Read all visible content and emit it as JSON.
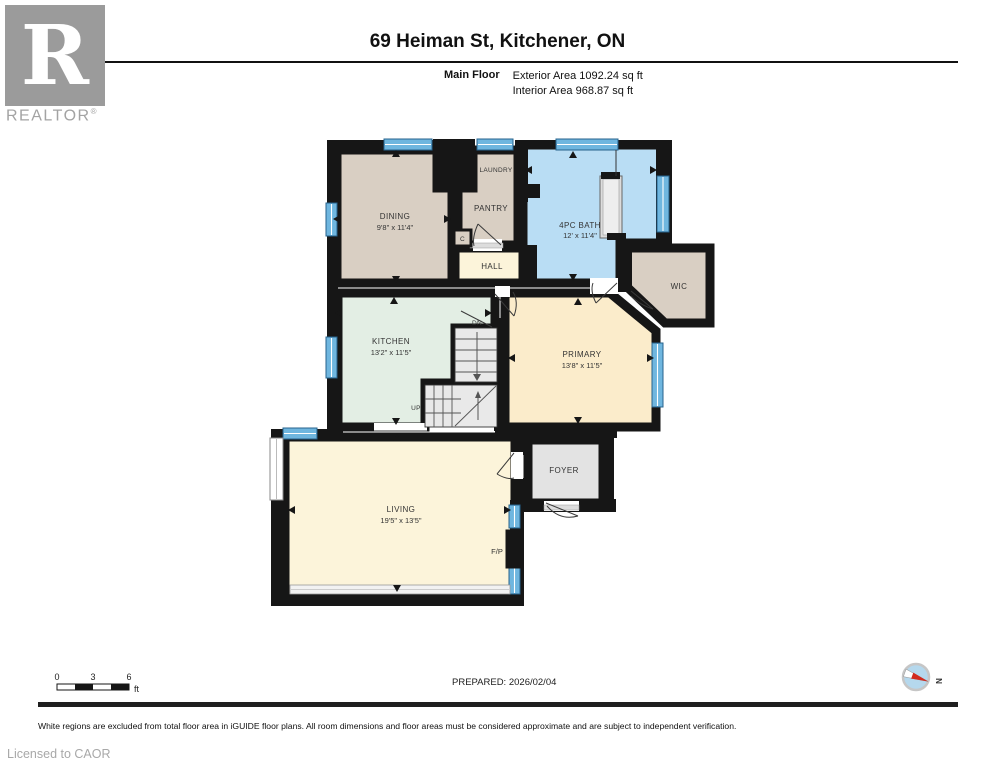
{
  "header": {
    "title": "69 Heiman St, Kitchener, ON",
    "floor_label": "Main Floor",
    "exterior_area": "Exterior Area 1092.24 sq ft",
    "interior_area": "Interior Area 968.87 sq ft",
    "logo_letter": "R",
    "logo_text": "REALTOR",
    "logo_registered": "®"
  },
  "rooms": {
    "dining": {
      "label": "DINING",
      "dims": "9'8\" x 11'4\""
    },
    "laundry": {
      "label": "LAUNDRY"
    },
    "pantry": {
      "label": "PANTRY"
    },
    "closet": {
      "label": "C"
    },
    "hall": {
      "label": "HALL"
    },
    "bath": {
      "label": "4PC BATH",
      "dims": "12' x 11'4\""
    },
    "wic": {
      "label": "WIC"
    },
    "kitchen": {
      "label": "KITCHEN",
      "dims": "13'2\" x 11'5\""
    },
    "primary": {
      "label": "PRIMARY",
      "dims": "13'8\" x 11'5\""
    },
    "foyer": {
      "label": "FOYER"
    },
    "living": {
      "label": "LIVING",
      "dims": "19'5\" x 13'5\""
    },
    "fireplace": {
      "label": "F/P"
    },
    "stairs_down": {
      "label": "DN"
    },
    "stairs_up": {
      "label": "UP"
    }
  },
  "scale_bar": {
    "tick0": "0",
    "tick1": "3",
    "tick2": "6",
    "unit": "ft"
  },
  "compass": {
    "north_label": "N"
  },
  "footer": {
    "prepared": "PREPARED: 2026/02/04",
    "disclaimer": "White regions are excluded from total floor area in iGUIDE floor plans. All room dimensions and floor areas must be considered approximate and are subject to independent verification.",
    "license": "Licensed to CAOR"
  },
  "colors": {
    "room_tan": "#d9cfc3",
    "room_cream": "#fcf4da",
    "room_blue": "#b9ddf4",
    "room_mint": "#e3eee4",
    "room_yellow": "#fbeccb",
    "room_gray": "#e3e3e3",
    "wall_black": "#161616",
    "window_blue": "#6fb6df",
    "compass_red": "#d22a1e"
  }
}
